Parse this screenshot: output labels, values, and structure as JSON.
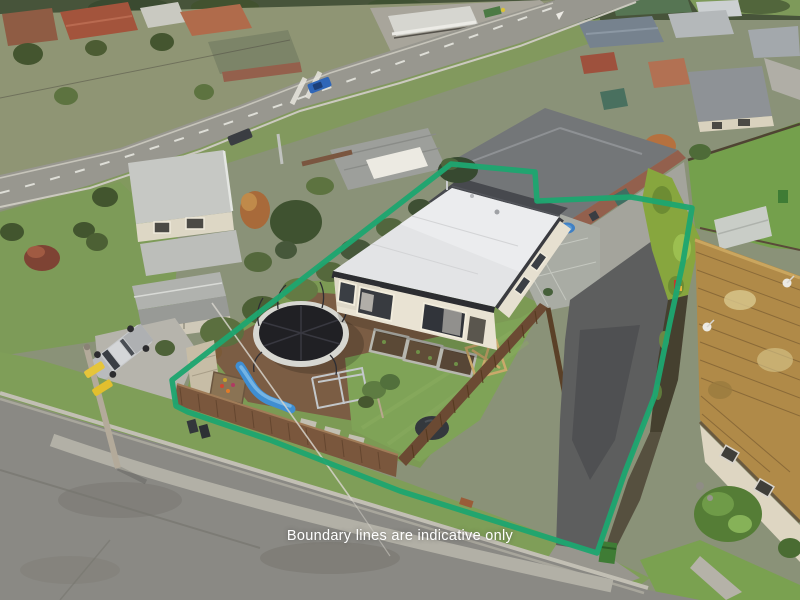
{
  "overlay": {
    "disclaimer": "Boundary lines are indicative only"
  },
  "boundary": {
    "color": "#1ea56f",
    "width": 5.5,
    "points": "451,164 535,172 537,201 631,197 692,208 683,262 670,322 655,395 625,472 597,553 400,491 270,440 188,412 176,406 172,380"
  },
  "palette": {
    "boundary_green": "#1ea56f",
    "disclaimer_text": "#ffffff",
    "subject_roof_white": "#e3e4e6",
    "roof_trim_charcoal": "#2c2d31",
    "lawn_green": "#7d9b58",
    "street_asphalt": "#8a8984",
    "driveway_asphalt": "#5d5e5e",
    "fence_brown": "#7a573d",
    "hedge_green": "#87a63e",
    "neighbor_roof_tan": "#b08a48",
    "trampoline_black": "#202024",
    "slide_blue": "#3f8ed2",
    "pool_blue": "#3f80c4"
  }
}
